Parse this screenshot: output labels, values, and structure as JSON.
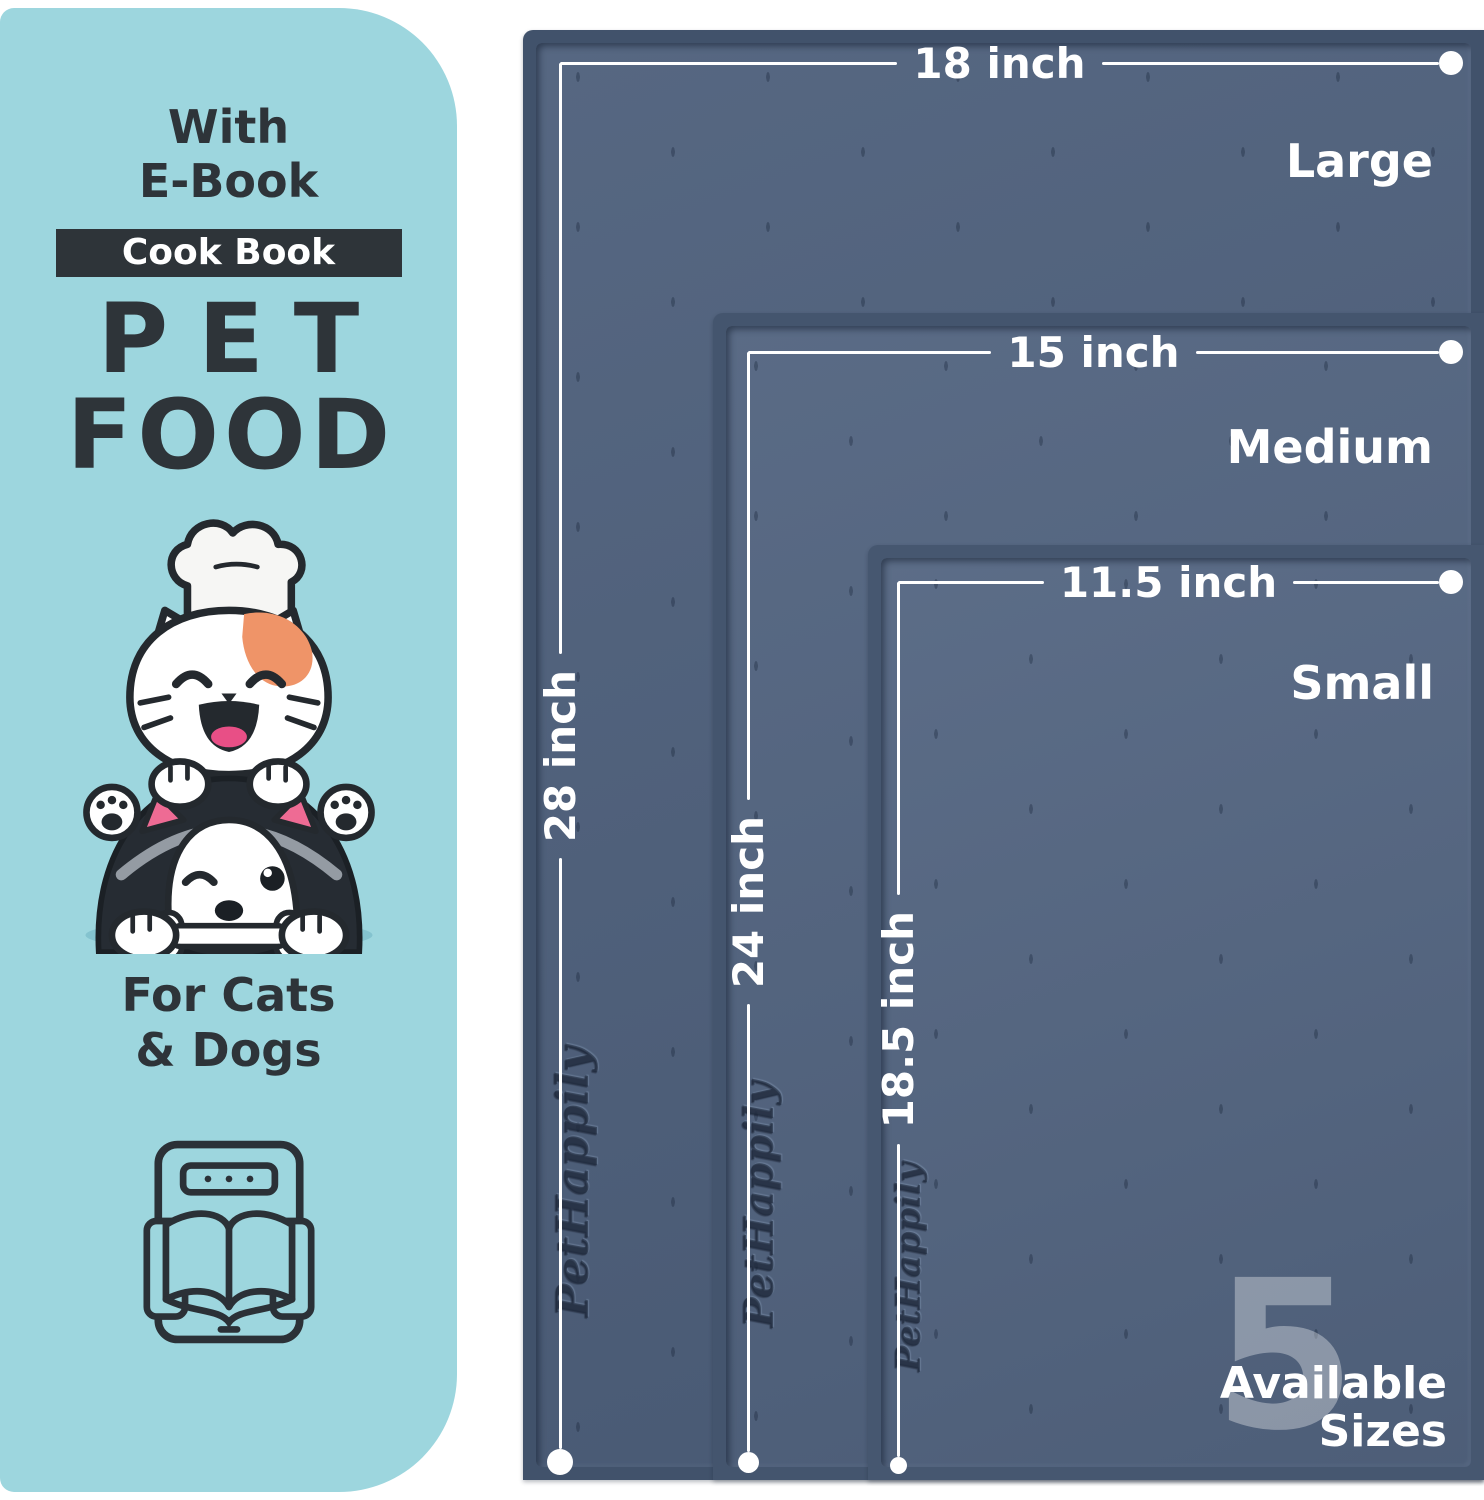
{
  "panel": {
    "header_line1": "With",
    "header_line2": "E-Book",
    "badge_label": "Cook Book",
    "title_line1": "PET",
    "title_line2": "FOOD",
    "footer_line1": "For Cats",
    "footer_line2": "& Dogs",
    "illustration": "cat-chef-with-husky-dog-and-bone",
    "icon": "ebook-tablet-open-book-icon",
    "bg_color": "#9dd6de",
    "text_color": "#2e3439"
  },
  "mats": [
    {
      "size_name": "Large",
      "width_label": "18 inch",
      "length_label": "28 inch",
      "brand_embossed": "PetHappily"
    },
    {
      "size_name": "Medium",
      "width_label": "15 inch",
      "length_label": "24 inch",
      "brand_embossed": "PetHappily"
    },
    {
      "size_name": "Small",
      "width_label": "11.5 inch",
      "length_label": "18.5 inch",
      "brand_embossed": "PetHappily"
    }
  ],
  "sizes_callout": {
    "number": "5",
    "label_line1": "Available",
    "label_line2": "Sizes"
  },
  "colors": {
    "panel_bg": "#9dd6de",
    "panel_text": "#2e3439",
    "mat_rim": "#42536c",
    "mat_surface": "#50627e",
    "dimension_line": "#ffffff",
    "accent_orange": "#ef9468",
    "accent_pink": "#e84f86"
  }
}
